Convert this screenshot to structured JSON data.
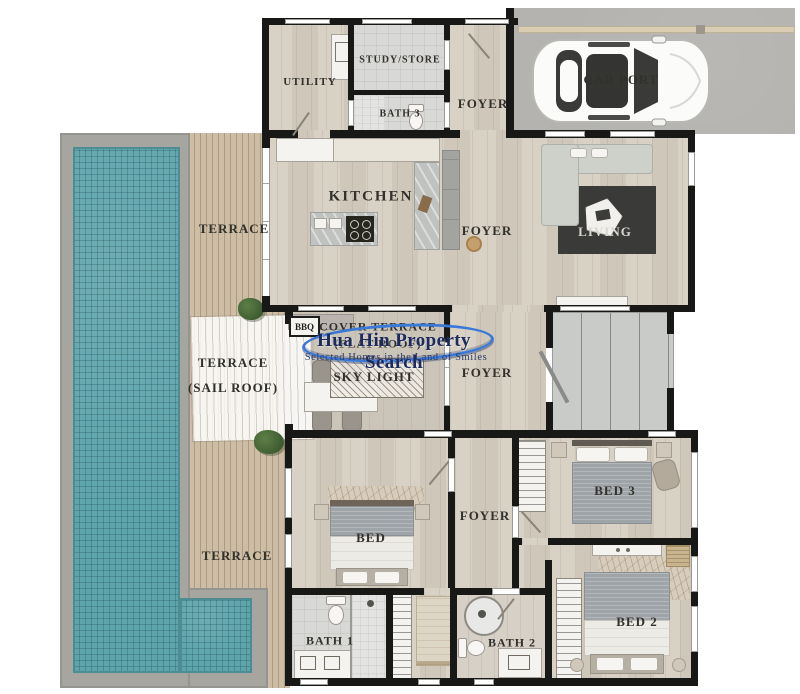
{
  "watermark": {
    "title": "Hua Hin Property Search",
    "tagline": "Selected Homes in the Land of Smiles"
  },
  "rooms": {
    "utility": "UTILITY",
    "study_store": "STUDY/STORE",
    "bath3": "BATH 3",
    "foyer_top": "FOYER",
    "car_port": "CAR PORT",
    "kitchen": "KITCHEN",
    "foyer_main": "FOYER",
    "living": "LIVING",
    "terrace_upper": "TERRACE",
    "bbq": "BBQ",
    "cover_terrace_line1": "COVER TERRACE",
    "cover_terrace_line2": "(FLAT ROOF)",
    "terrace_sail_line1": "TERRACE",
    "terrace_sail_line2": "(SAIL ROOF)",
    "sky_light": "SKY LIGHT",
    "foyer_mid": "FOYER",
    "bed_master": "BED",
    "foyer_lower": "FOYER",
    "bed3": "BED 3",
    "terrace_lower": "TERRACE",
    "bed2": "BED 2",
    "bath1": "BATH 1",
    "bath2": "BATH 2"
  },
  "palette": {
    "pool_water": "#5da4ab",
    "deck_wood": "#cdbda4",
    "interior_wood": "#d6cec1",
    "wall_black": "#181816",
    "carport_concrete": "#b4b3af",
    "rug_dark": "#3a3a38",
    "watermark_navy": "#1d2a5e",
    "watermark_blue": "#3a79d8"
  }
}
